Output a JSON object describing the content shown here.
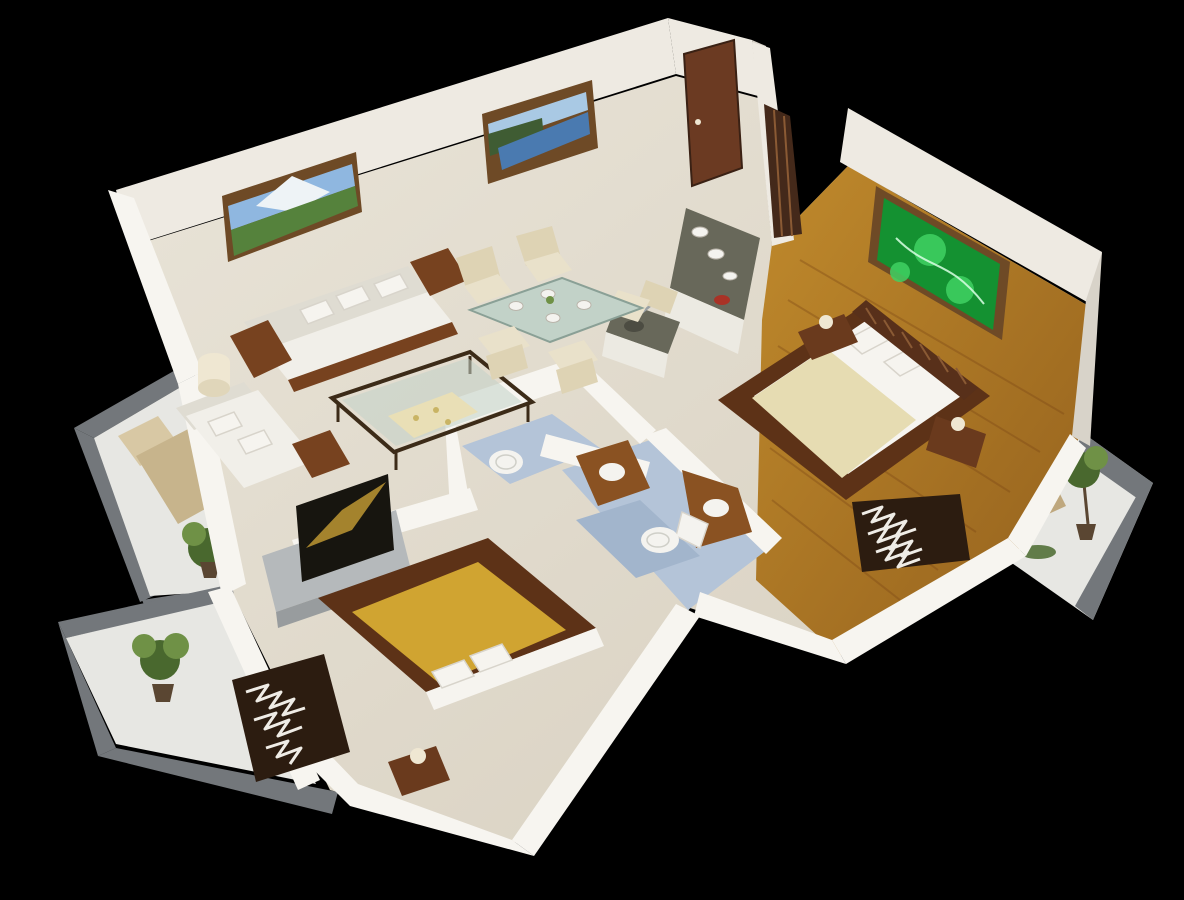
{
  "view": {
    "type": "3d-isometric-floor-plan-render",
    "subject": "two-bedroom apartment cutaway model on black background"
  },
  "rooms": [
    {
      "name": "living-room",
      "objects": [
        "three-seat-sofa",
        "loveseat",
        "coffee-table",
        "table-lamp",
        "mountain-painting",
        "lake-painting"
      ]
    },
    {
      "name": "dining-area",
      "objects": [
        "glass-dining-table",
        "dining-chairs",
        "plates",
        "flower-vase"
      ]
    },
    {
      "name": "kitchen",
      "objects": [
        "l-shaped-counter",
        "sink",
        "entry-door",
        "wardrobe",
        "red-bowl"
      ]
    },
    {
      "name": "master-bedroom",
      "objects": [
        "double-bed",
        "slatted-headboard",
        "nightstands",
        "bedside-lamps",
        "zebra-rug",
        "abstract-green-painting",
        "wood-plank-floor"
      ]
    },
    {
      "name": "bathroom-small",
      "objects": [
        "round-toilet",
        "blue-floor"
      ]
    },
    {
      "name": "bathroom-main",
      "objects": [
        "toilet",
        "wood-vanities",
        "round-sinks",
        "blue-floor",
        "bath-mat"
      ]
    },
    {
      "name": "second-bedroom",
      "objects": [
        "platform-bed-gold",
        "tv-unit",
        "flat-tv",
        "nightstand",
        "zebra-rug"
      ]
    },
    {
      "name": "balcony-left-mid",
      "objects": [
        "lounge-chair",
        "potted-plant",
        "gray-railing"
      ]
    },
    {
      "name": "balcony-left-bottom",
      "objects": [
        "potted-plant",
        "gray-railing"
      ]
    },
    {
      "name": "balcony-right",
      "objects": [
        "wicker-chair",
        "potted-tree",
        "plants",
        "gray-railing"
      ]
    }
  ],
  "palette": {
    "bg": "#000000",
    "wallBright": "#f7f5f0",
    "wallFace": "#eeeae2",
    "wallShade": "#d8d3c9",
    "floorCream": "#e9e4d8",
    "floorCreamDeep": "#d7cfbf",
    "woodFloor": "#c08a2c",
    "woodFloorDeep": "#93601d",
    "woodBorder": "#5d3217",
    "plankLine": "#7a4514",
    "bathFloor": "#b4c4d8",
    "bathFloorDeep": "#a2b5cc",
    "balconyFloor": "#e7e7e3",
    "railGray": "#73777b",
    "plantDark": "#49682e",
    "plantLight": "#6f9146",
    "potBrown": "#5a4632",
    "loungeTan": "#c7b48c",
    "loungeTanLight": "#d8c8a4",
    "wickerTan": "#cdbb96",
    "wickerTanDeep": "#bfa87e",
    "sofaWhite": "#f1efe9",
    "sofaShade": "#dfdcd2",
    "sofaWood": "#77421f",
    "pillowWhite": "#f6f4ef",
    "glass": "#c2d2c8",
    "frameDark": "#3c2b18",
    "runner": "#e9dfb6",
    "runnerDot": "#c9b464",
    "chairCream": "#e9e1ca",
    "chairCreamDeep": "#ded3b4",
    "bedCream": "#e6dcb2",
    "bedGold": "#d0a431",
    "headboard": "#58301a",
    "headboardSlat": "#8a5a34",
    "nightstand": "#6a3a1d",
    "lampCream": "#efe7d2",
    "lampCreamDeep": "#e0d6ba",
    "zebraDark": "#2c1c10",
    "zebraLight": "#efece6",
    "doorWood": "#6b3a22",
    "doorDark": "#44291a",
    "counterTop": "#68685a",
    "counterFace": "#eceae2",
    "sinkDark": "#4c4c42",
    "steel": "#9aa0a4",
    "redBowl": "#a93226",
    "tvGray": "#b5b9bb",
    "tvGrayDeep": "#989c9e",
    "tvDark": "#17150f",
    "tvGold": "#bd9733",
    "skyBlue": "#8fb7e0",
    "mountainWhite": "#eef3f6",
    "meadowGreen": "#55823c",
    "lakeSky": "#a9c9e4",
    "lakeWater": "#4a7ab0",
    "lakeTrees": "#3f5c33",
    "paintFrame": "#6e4a26",
    "abstractGreen": "#149131",
    "abstractLight": "#3fd163",
    "abstractStreak": "#d9ffe4",
    "toiletWhite": "#f4f3ef",
    "toiletLine": "#cfcfc8",
    "vanityWood": "#8a5222"
  }
}
